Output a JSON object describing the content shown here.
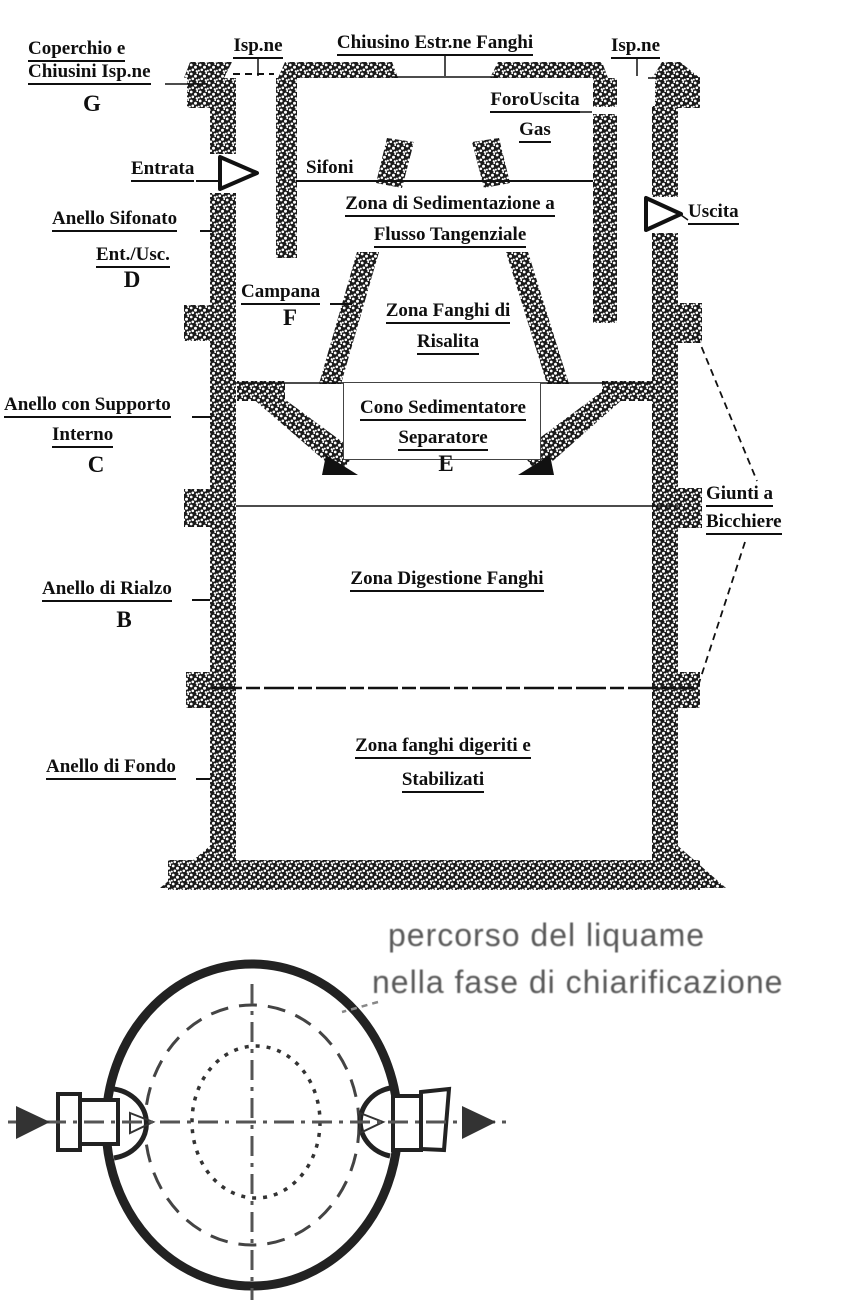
{
  "diagram": {
    "top_labels": {
      "ispne_left": "Isp.ne",
      "chiusino": "Chiusino Estr.ne Fanghi",
      "ispne_right": "Isp.ne"
    },
    "left_labels": {
      "coperchio_1": "Coperchio e",
      "coperchio_2": "Chiusini Isp.ne",
      "coperchio_letter": "G",
      "entrata": "Entrata",
      "anello_sifonato_1": "Anello Sifonato",
      "anello_sifonato_2": "Ent./Usc.",
      "anello_sifonato_letter": "D",
      "anello_supporto_1": "Anello con Supporto",
      "anello_supporto_2": "Interno",
      "anello_supporto_letter": "C",
      "anello_rialzo": "Anello di Rialzo",
      "anello_rialzo_letter": "B",
      "anello_fondo": "Anello di Fondo"
    },
    "right_labels": {
      "foro_uscita_1": "ForoUscita",
      "foro_uscita_2": "Gas",
      "uscita": "Uscita",
      "giunti_1": "Giunti a",
      "giunti_2": "Bicchiere"
    },
    "inner_labels": {
      "sifoni": "Sifoni",
      "zona_sedimentazione_1": "Zona di Sedimentazione a",
      "zona_sedimentazione_2": "Flusso Tangenziale",
      "campana": "Campana",
      "campana_letter": "F",
      "zona_fanghi_1": "Zona Fanghi di",
      "zona_fanghi_2": "Risalita",
      "cono_1": "Cono Sedimentatore",
      "cono_2": "Separatore",
      "cono_letter": "E",
      "zona_digestione": "Zona Digestione Fanghi",
      "zona_digeriti_1": "Zona fanghi digeriti e",
      "zona_digeriti_2": "Stabilizati"
    },
    "plan_view": {
      "caption_1": "percorso del liquame",
      "caption_2": "nella fase di chiarificazione"
    },
    "colors": {
      "ink": "#111111",
      "plan_ink": "#2a2a2a",
      "caption_gray": "#595959",
      "paper": "#ffffff"
    }
  }
}
